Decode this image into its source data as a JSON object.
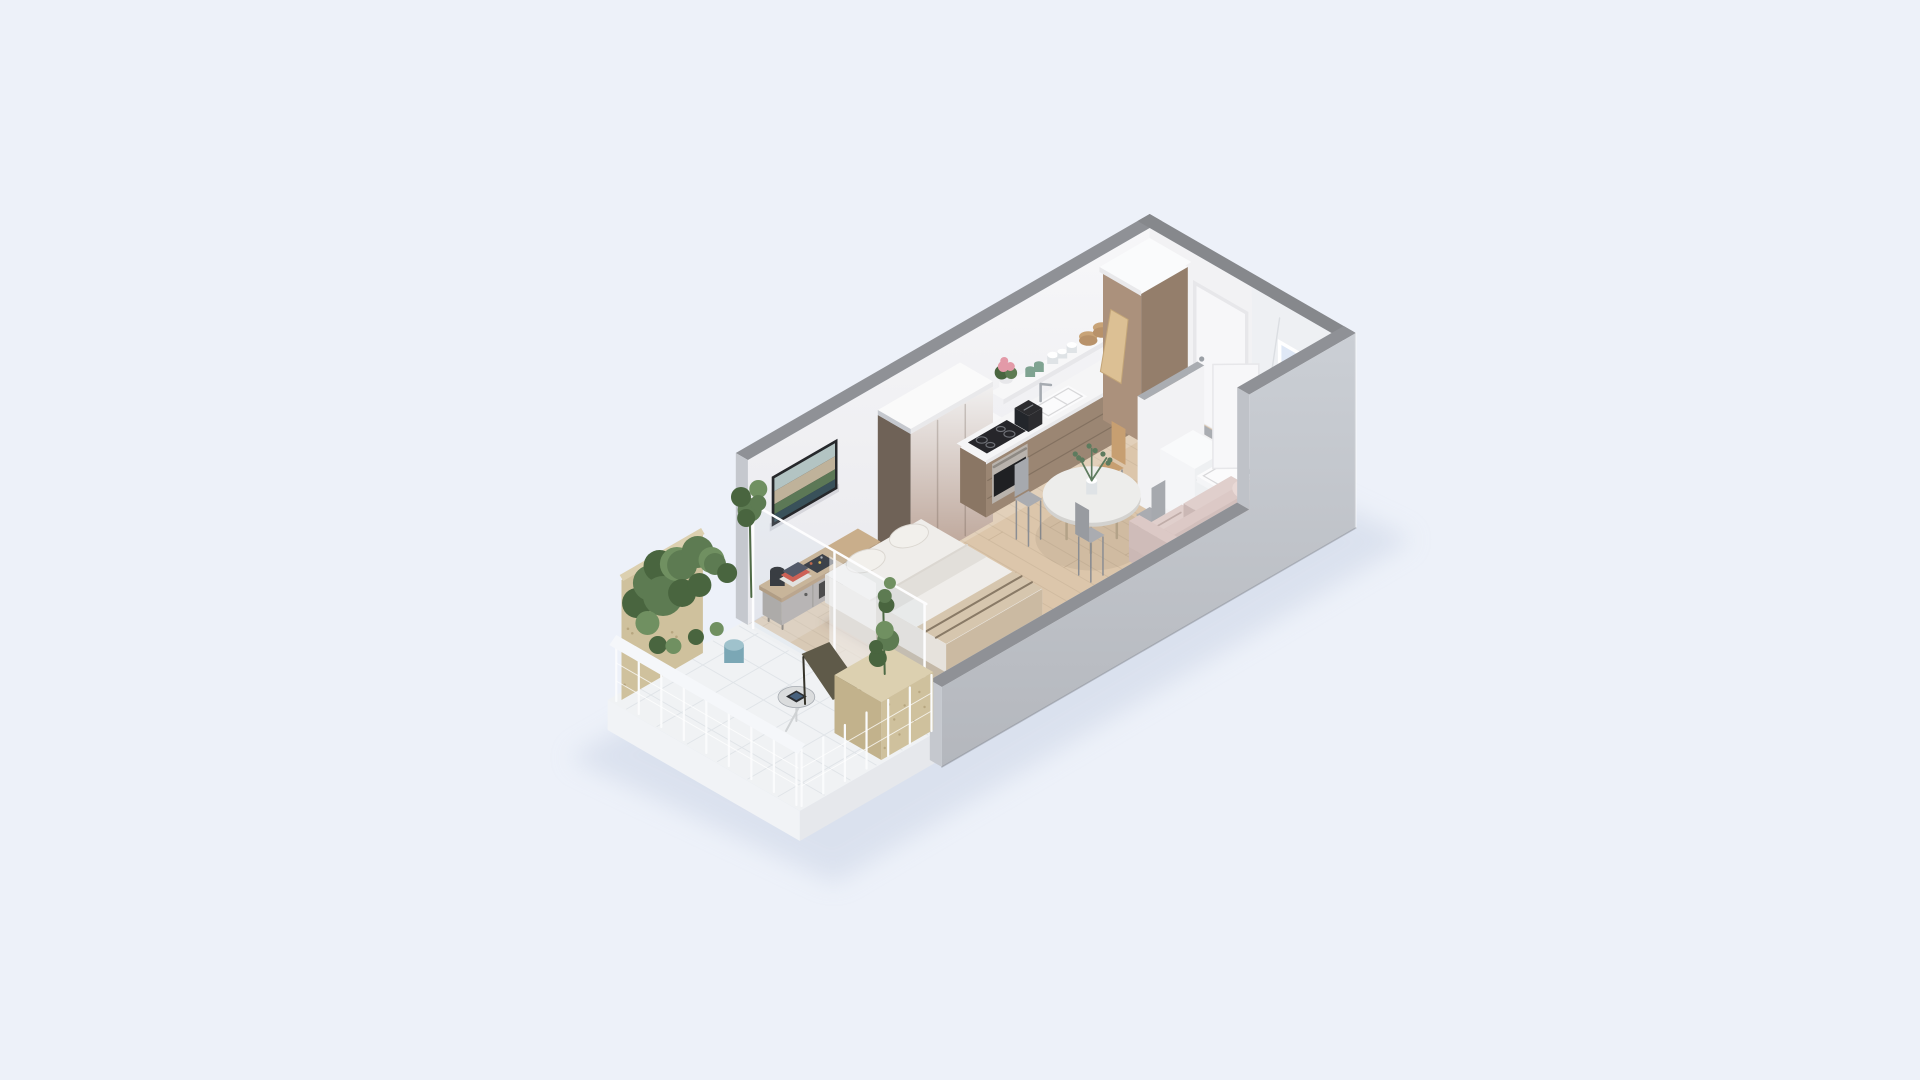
{
  "scene": {
    "description": "Isometric 3D cutaway floor plan render of a studio apartment with balcony, living-bedroom, kitchen, hallway and marble bathroom",
    "rooms": [
      {
        "name": "balcony"
      },
      {
        "name": "living-bedroom"
      },
      {
        "name": "kitchen"
      },
      {
        "name": "hallway"
      },
      {
        "name": "bathroom"
      }
    ],
    "objects": [
      "balcony-railing",
      "balcony-plants",
      "plywood-privacy-panel",
      "lounge-chair",
      "side-table",
      "tablet",
      "planter-box",
      "blue-pot",
      "glass-partition",
      "double-bed",
      "pillows",
      "throw-blanket",
      "tv",
      "tv-console",
      "books",
      "black-vase",
      "wardrobe",
      "kitchen-counter",
      "cooktop",
      "oven",
      "sink",
      "faucet",
      "toaster",
      "floating-shelf",
      "flower-pot",
      "cups",
      "glasses",
      "wooden-bowls",
      "tall-cabinet",
      "cutting-board",
      "entrance-door",
      "window",
      "dining-table",
      "vase-with-eucalyptus",
      "dining-chairs",
      "sofa",
      "bathroom-partition",
      "washing-machine",
      "shower-tray",
      "bathroom-bench",
      "bathroom-door"
    ]
  },
  "palette": {
    "bg": "#edf1f9",
    "shadow": "#ccd5e6",
    "wallTopStrip": "#8f9196",
    "wallTopStripDark": "#86888c",
    "endCap": "#c5c8ce",
    "stepCap": "#bfc2c8",
    "extTop": "#cbcfd5",
    "extBottom": "#b4b7bd",
    "extBase": "#a8abb1",
    "lowWallInner": "#dadce0",
    "wallTopGrad": "#f7f7f9",
    "wallBottomGrad": "#e9e9ed",
    "wallWhite": "#f2f2f4",
    "marbleWall": "#eef0f3",
    "marbleFloor": "#f1f2f4",
    "marbleVein": "#d7dade",
    "windowLight": "#dfe8f6",
    "windowFrame": "#ffffff",
    "doorFrame": "#e7e7ea",
    "doorLeaf": "#f7f7f9",
    "doorHandle": "#9ba0a6",
    "wood": "#dcc6ab",
    "woodLine": "#c9b49a",
    "woodSeam": "#c2ab8f",
    "balconyFloor": "#f0f2f4",
    "balconyLine": "#e0e4e8",
    "balconySlabSW": "#f1f3f6",
    "balconySlabSE": "#e6e8ec",
    "threshold": "#eef0f2",
    "cabinetFront": "#9b8673",
    "cabinetSide": "#8a7664",
    "cabinetGroove": "#7e6c5c",
    "counterWhite": "#f5f5f6",
    "counterEdge": "#e9e9eb",
    "cooktopGlass": "#26262a",
    "cooktopRing": "#6e7076",
    "ovenSteel": "#b9b3ad",
    "ovenGlass": "#1f2023",
    "ovenHandle": "#8e8983",
    "sinkWhite": "#fbfbfc",
    "sinkLine": "#d8d8da",
    "chrome": "#a6abb1",
    "toasterBlack": "#2c2c2f",
    "shelfWhite": "#f7f7f8",
    "shelfEdge": "#e7e7ea",
    "flowerPink": "#e39aa8",
    "cupGreen": "#7fa391",
    "glassCup": "#dfe3e6",
    "woodBowl": "#c8a377",
    "woodBowlDark": "#b8926a",
    "tealVase": "#4e7f8c",
    "boardWood": "#dcc094",
    "boardEdge": "#c3a578",
    "columnSW": "#ab917c",
    "columnSE": "#947e6b",
    "columnTop": "#fafbfc",
    "wardSide": "#6f6257",
    "wardTop": "#fafafa",
    "wardGradTop": "#f1f0f0",
    "wardGradBottom": "#b79d8f",
    "wardSeam": "rgba(90,75,65,0.25)",
    "consoleWoodTop": "#c9ae8b",
    "consoleWoodSE": "#b99d7c",
    "consoleWoodSW": "#ad9271",
    "consoleGray": "#b5afab",
    "consoleGraySW": "#a8a29d",
    "consoleOpen": "#35322e",
    "consoleHandle": "#4a4743",
    "consoleLeg": "#8a8178",
    "bookLight": "#e8e4dd",
    "bookRed": "#cf4b3a",
    "bookDark": "#3d4250",
    "radioBlack": "#23262b",
    "radioDotA": "#c2542f",
    "radioDotB": "#e0b23e",
    "vaseBlack": "#1e2022",
    "tvFrame": "#26282b",
    "tvSky": "#b3c4c3",
    "tvTown": "#bfb29a",
    "tvGreen": "#5c7856",
    "tvSea": "#39515a",
    "bedBaseSE": "#cfc2ad",
    "bedBaseSW": "#c4b8a6",
    "bedBaseTop": "#d9cdbb",
    "mattressTop": "#efedea",
    "mattressSE": "#e0dcd6",
    "mattressSW": "#e6e2dc",
    "duvetFold": "#e2dfda",
    "pillow": "#f2f0ec",
    "pillowShade": "#dbd7d1",
    "throwTop": "#d6c6ae",
    "throwDrape": "#cbbaa2",
    "throwStrap": "#70614f",
    "underShadow": "rgba(90,80,65,0.18)",
    "tableTop": "#ededeb",
    "tableEdge": "#d3d2cf",
    "tableLeg": "#b3a288",
    "chairGray": "#a6a9ae",
    "chairGraySeat": "#aaacb1",
    "chairGrayDark": "#989ba0",
    "chairLeg": "#8b8e93",
    "chairTan": "#c79f71",
    "sprigGreen": "#5d7b5e",
    "sofaBase": "#c9b6b3",
    "sofaSeatTop": "#e0cfcc",
    "sofaSeatSE": "#d2bfbc",
    "sofaSeatSW": "#cbb8b5",
    "sofaBackTop": "#dcc9c6",
    "sofaBackSW": "#cfbcb9",
    "sofaPillow": "#e9d9d6",
    "sofaFold": "rgba(120,95,90,0.3)",
    "partWhite": "#f2f2f4",
    "partCap": "#aaadb2",
    "fixtureWhite": "#f9fafb",
    "fixtureSE": "#eef0f2",
    "fixtureSW": "#f4f5f7",
    "traySlot": "#9aa0a6",
    "glassPane": "rgba(200,220,235,0.16)",
    "glassFrame": "#fdfdfe",
    "plywood": "#cfc19d",
    "plywoodDark": "#c2b28c",
    "plywoodCap": "#dcd0b0",
    "plywoodDot": "#b09f78",
    "plantA": "#5d7b52",
    "plantB": "#49653f",
    "plantC": "#709061",
    "stemGreen": "#4e6a45",
    "bluePot": "#7ba7b5",
    "bluePotTop": "#9fc2cc",
    "oliveBack": "#5f5a49",
    "oliveSeat": "#6b6554",
    "oliveFrame": "#36342a",
    "sideTableTop": "#dadcdd",
    "sideTableLeg": "#cfd2d4",
    "tabletBody": "#2c2e31",
    "tabletScreen": "#47617d",
    "railWhite": "#f5f7fa",
    "railPost": "#fafbfc",
    "railCable": "rgba(255,255,255,0.75)",
    "aoLine": "rgba(90,90,100,0.15)",
    "woodHighlight": "rgba(255,255,255,0.18)",
    "woodShade": "rgba(130,95,60,0.07)",
    "edgeHighlight": "rgba(255,255,255,0.35)",
    "baseEdge": "rgba(120,125,135,0.4)"
  }
}
